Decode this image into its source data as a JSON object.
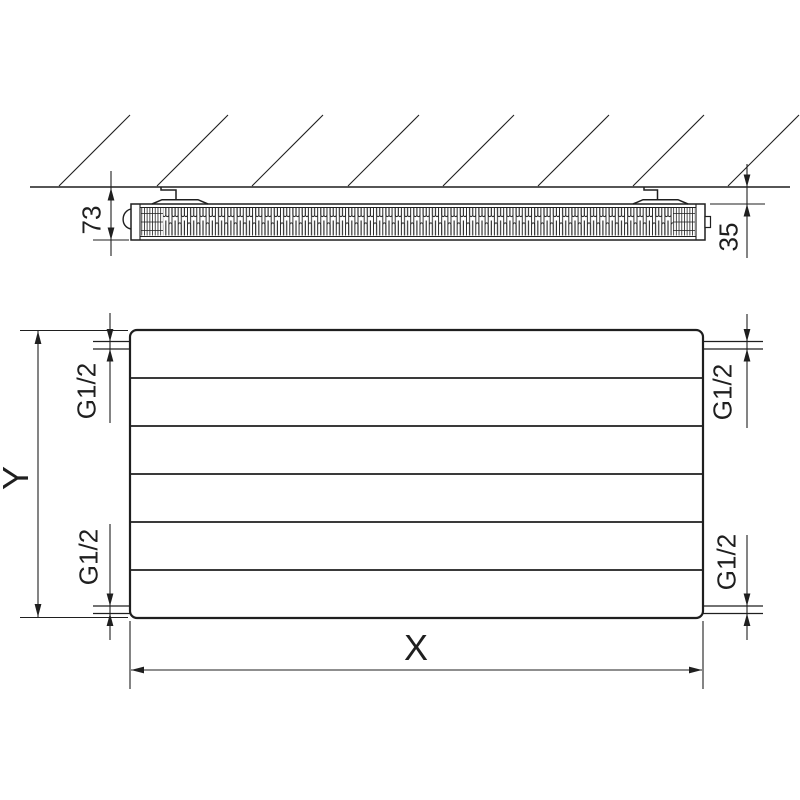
{
  "drawing": {
    "title": "panel-radiator-dimension-drawing",
    "side_view": {
      "depth": "73",
      "wall_distance": "35"
    },
    "front_view": {
      "width": "X",
      "height": "Y",
      "connections": {
        "top_left": "G1/2",
        "top_right": "G1/2",
        "bottom_left": "G1/2",
        "bottom_right": "G1/2"
      }
    },
    "colors": {
      "line": "#1f1f1f",
      "text": "#1f1f1f",
      "background": "#ffffff"
    }
  }
}
